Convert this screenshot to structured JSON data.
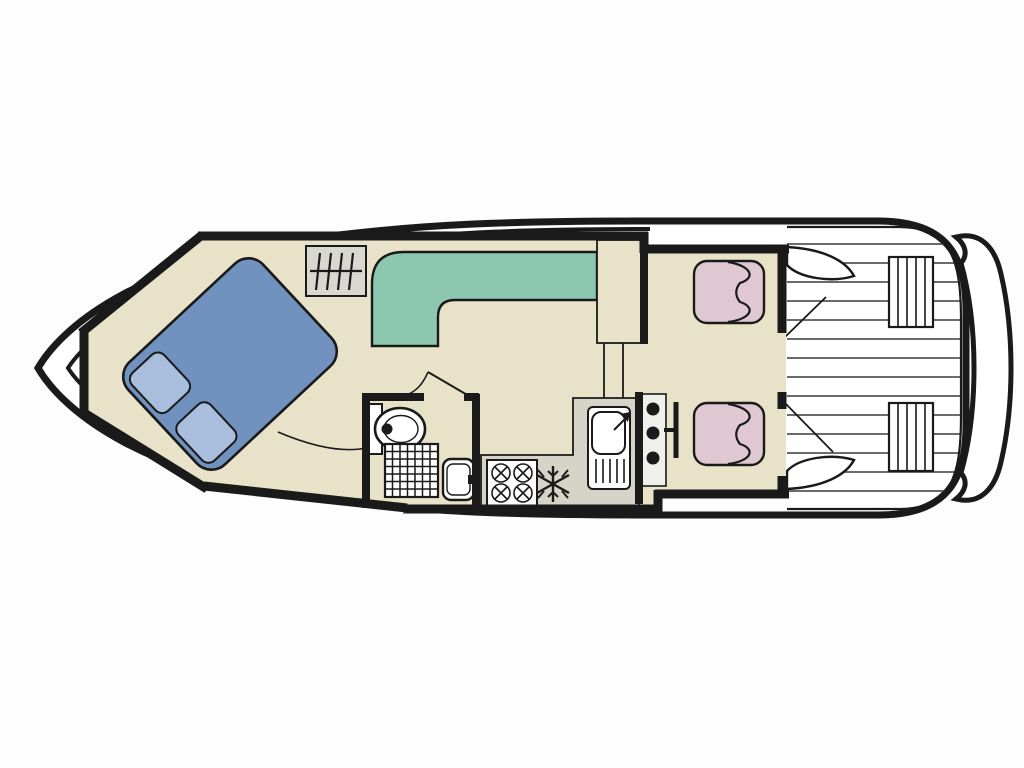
{
  "page": {
    "background": "#FDFDFD",
    "description": "Top-view deck plan of a motor cruiser houseboat"
  },
  "colors": {
    "outline": "#1A1A1A",
    "white": "#FFFFFF",
    "floor": "#E8E3C8",
    "bed": "#7191BE",
    "pillow": "#A9BDDC",
    "sofa": "#8CC8B0",
    "seat": "#DFC8D2",
    "counter": "#D5D4C6",
    "hatch": "#D9D8D0",
    "console": "#F0F0EA",
    "plank": "#3A3A3A",
    "fixture": "#FFFFFF"
  },
  "plan": {
    "areas": [
      "bow-cabin",
      "saloon",
      "bathroom",
      "galley",
      "helm",
      "aft-deck",
      "swim-platform"
    ],
    "fixtures": [
      "double-bed",
      "pillows",
      "l-shaped-sofa",
      "companionway-steps",
      "toilet",
      "shower",
      "washbasin",
      "galley-sink",
      "four-burner-stove",
      "fridge-snowflake",
      "helm-console",
      "steering-wheel",
      "helm-seats",
      "deck-benches"
    ]
  }
}
